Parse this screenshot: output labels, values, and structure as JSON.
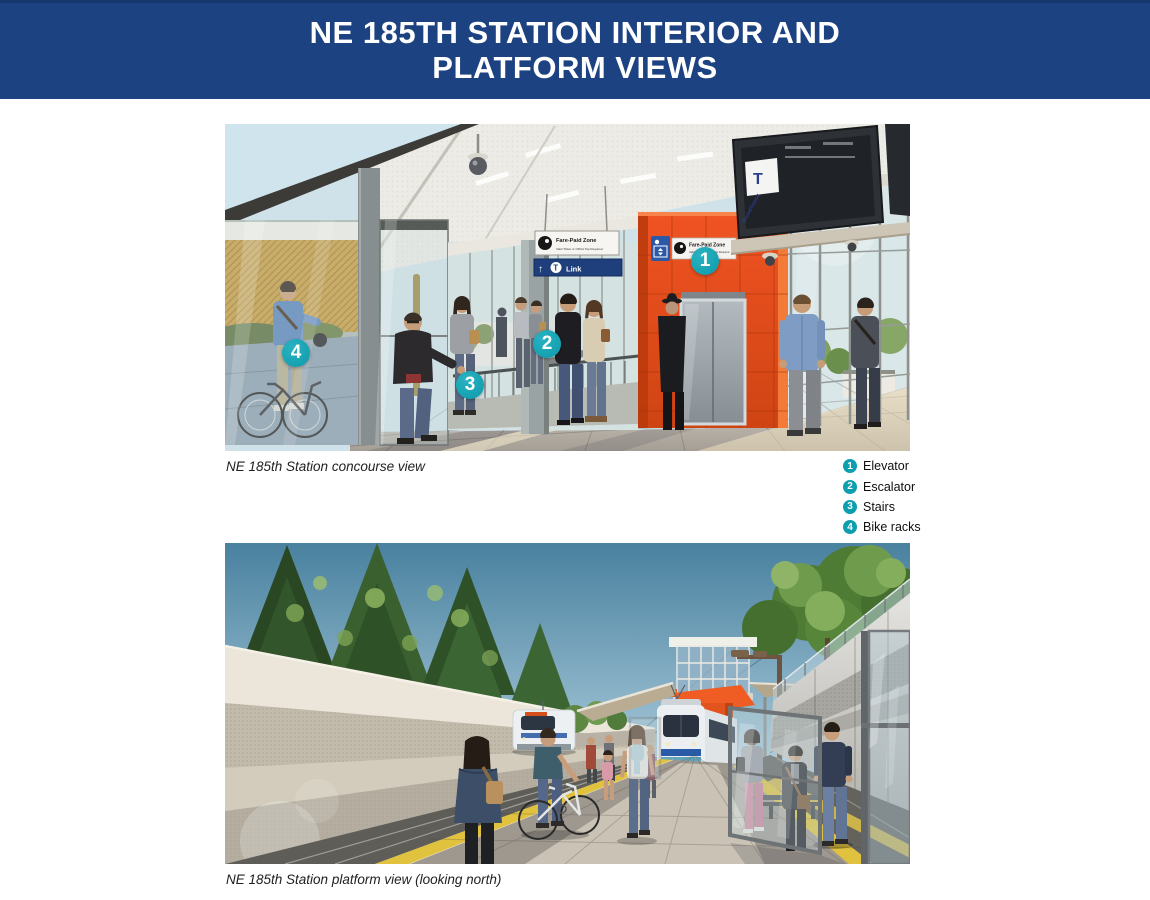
{
  "header": {
    "title_line1": "NE 185TH STATION INTERIOR AND",
    "title_line2": "PLATFORM VIEWS"
  },
  "concourse": {
    "caption": "NE 185th Station concourse view",
    "markers": [
      {
        "number": "1",
        "label": "Elevator"
      },
      {
        "number": "2",
        "label": "Escalator"
      },
      {
        "number": "3",
        "label": "Stairs"
      },
      {
        "number": "4",
        "label": "Bike racks"
      }
    ],
    "signs": {
      "fare_paid_title": "Fare-Paid Zone",
      "fare_paid_subtitle": "Valid Ticket or ORCA Tap Required",
      "link_arrow": "↑",
      "link_label": "Link",
      "logo_letter": "T",
      "screen_brand": "SoundTransit"
    }
  },
  "legend": {
    "items": [
      {
        "number": "1",
        "label": "Elevator"
      },
      {
        "number": "2",
        "label": "Escalator"
      },
      {
        "number": "3",
        "label": "Stairs"
      },
      {
        "number": "4",
        "label": "Bike racks"
      }
    ]
  },
  "platform": {
    "caption": "NE 185th Station platform view (looking north)"
  },
  "colors": {
    "banner_blue": "#1c4282",
    "marker_teal": "#12a4b4",
    "tower_orange": "#e84e1d",
    "tactile_yellow": "#e0c23f"
  }
}
